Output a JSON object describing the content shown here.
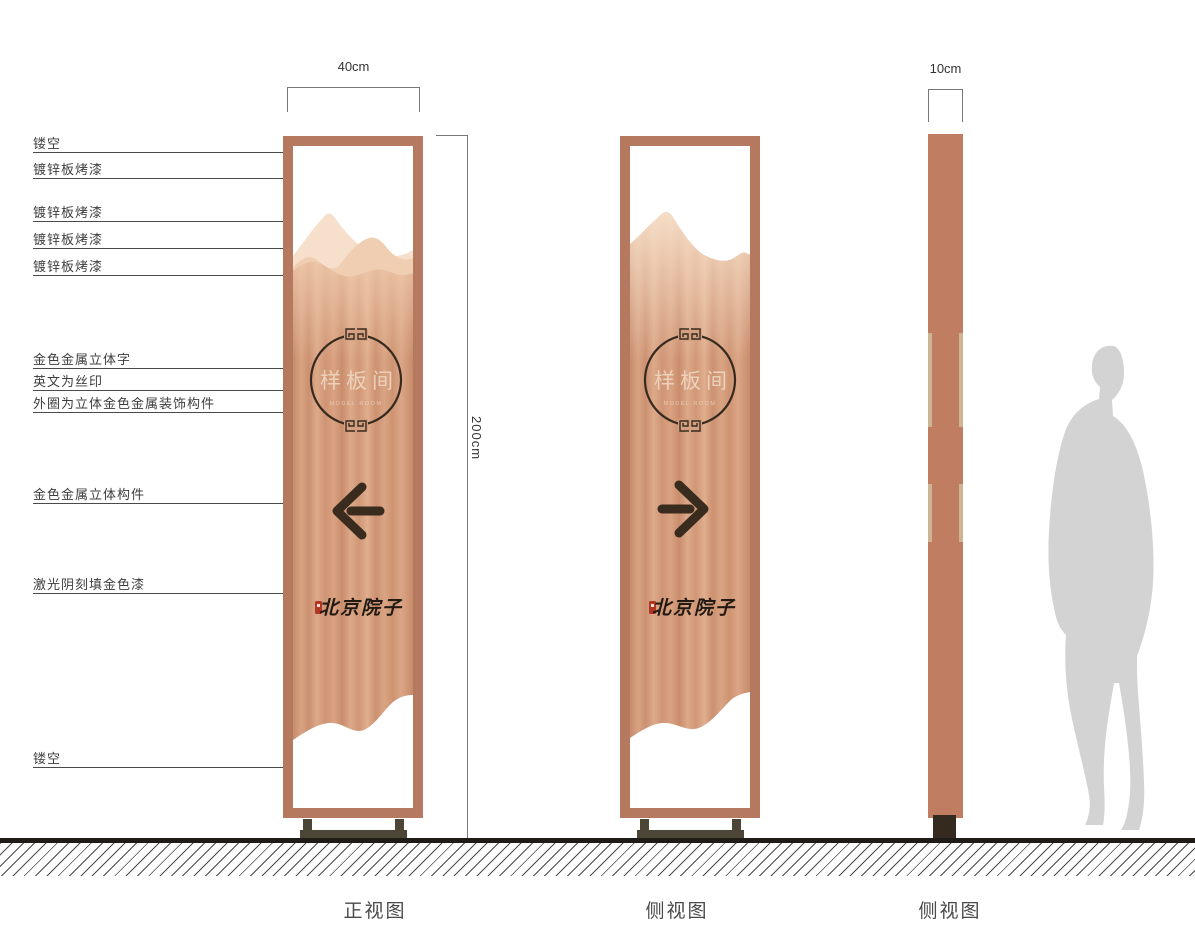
{
  "dimension_labels": {
    "front_width": "40cm",
    "height": "200cm",
    "profile_depth": "10cm"
  },
  "annotations": [
    {
      "label": "镂空"
    },
    {
      "label": "镀锌板烤漆"
    },
    {
      "label": "镀锌板烤漆"
    },
    {
      "label": "镀锌板烤漆"
    },
    {
      "label": "镀锌板烤漆"
    },
    {
      "label": "金色金属立体字"
    },
    {
      "label": "英文为丝印"
    },
    {
      "label": "外圈为立体金色金属装饰构件"
    },
    {
      "label": "金色金属立体构件"
    },
    {
      "label": "激光阴刻填金色漆"
    },
    {
      "label": "镂空"
    }
  ],
  "sign": {
    "room_name": "样板间",
    "english_name": "MODEL ROOM",
    "brand_name": "北京院子"
  },
  "views": [
    {
      "label": "正视图"
    },
    {
      "label": "侧视图"
    },
    {
      "label": "侧视图"
    }
  ],
  "icons": {
    "front_arrow": "left-arrow",
    "side_arrow": "right-arrow"
  },
  "colors": {
    "frame_copper": "#b5795f",
    "panel_copper": "#d39c7c",
    "mountain_light": "#f7e0cb",
    "accent_dark": "#3a2b1f",
    "seal_red": "#b03724",
    "base_olive": "#4b4636",
    "silhouette_gray": "#d3d3d4"
  }
}
